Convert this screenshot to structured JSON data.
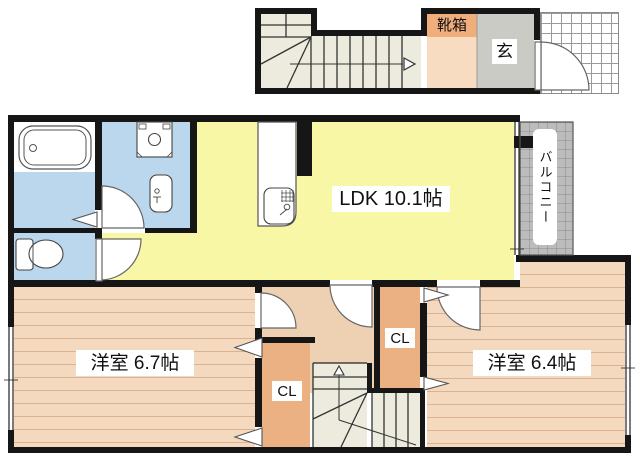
{
  "title": "2F floor plan",
  "labels": {
    "ldk": "LDK 10.1帖",
    "room_left": "洋室 6.7帖",
    "room_right": "洋室 6.4帖",
    "closet": "CL",
    "balcony": "バルコニー",
    "shoe_box": "靴箱",
    "entrance": "玄"
  },
  "rooms": [
    {
      "name": "LDK",
      "size_jo": 10.1
    },
    {
      "name": "洋室 (west bedroom)",
      "size_jo": 6.7
    },
    {
      "name": "洋室 (east bedroom)",
      "size_jo": 6.4
    },
    {
      "name": "バルコニー"
    },
    {
      "name": "玄関 / 靴箱"
    },
    {
      "name": "CL (closet)",
      "count": 2
    }
  ],
  "colors": {
    "ldk": "#f8f7a5",
    "wet_rooms": "#bad7ed",
    "bedroom": "#f4d9bf",
    "hallway": "#eed0b2",
    "closet": "#ebb183",
    "stairs": "#edebdd",
    "entrance_floor": "#cbcbc5",
    "shoe_box_strip": "#efae7c",
    "shoe_floor": "#f7dcc1",
    "balcony": "#bcbcbc",
    "wall": "#161616"
  }
}
